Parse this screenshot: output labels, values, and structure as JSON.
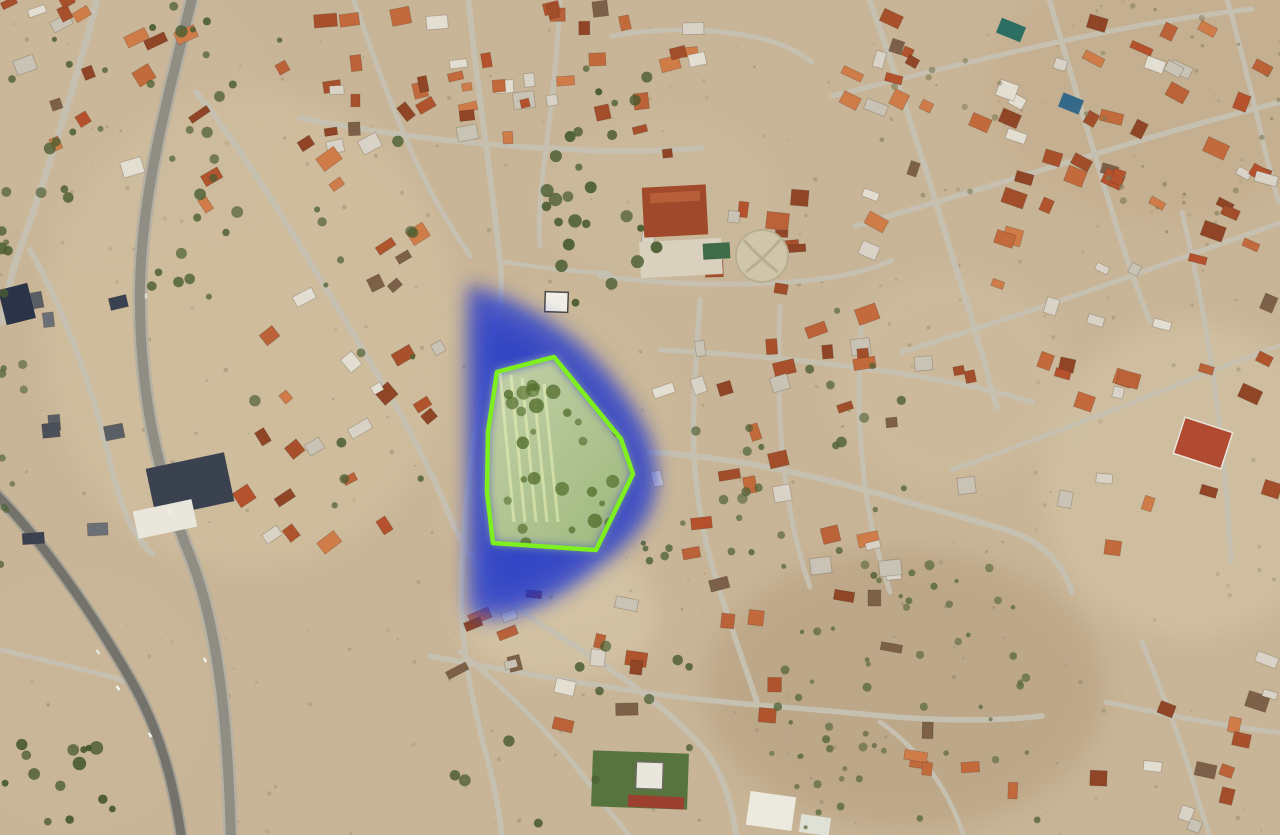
{
  "scene": {
    "width": 1280,
    "height": 835,
    "base_color": "#c8b496",
    "seed": 11
  },
  "palettes": {
    "roof": [
      "#b0542e",
      "#c26a3c",
      "#a34e2a",
      "#cf7c49",
      "#8f4526",
      "#bb6238",
      "#e3ded2",
      "#c9c3b5",
      "#7c6048",
      "#b5512c",
      "#a8502b",
      "#d8d3c6"
    ],
    "dark": [
      "#3a4150",
      "#2e3442",
      "#4a4f58",
      "#5a5f66",
      "#6b6f76"
    ],
    "road_color": "#c6c0b1",
    "building_stroke": "rgba(60,40,25,0.25)"
  },
  "fields": [
    {
      "cx": 250,
      "cy": 330,
      "rx": 210,
      "ry": 240,
      "f": "#d4c3a3",
      "o": 0.55
    },
    {
      "cx": 120,
      "cy": 120,
      "rx": 160,
      "ry": 140,
      "f": "#cdbb9d",
      "o": 0.4
    },
    {
      "cx": 560,
      "cy": 450,
      "rx": 130,
      "ry": 170,
      "f": "#cdbb9b",
      "o": 0.5
    },
    {
      "cx": 560,
      "cy": 615,
      "rx": 100,
      "ry": 65,
      "f": "#d8c9ab",
      "o": 0.6
    },
    {
      "cx": 905,
      "cy": 690,
      "rx": 200,
      "ry": 140,
      "f": "#b59e7f",
      "o": 0.55
    },
    {
      "cx": 1190,
      "cy": 480,
      "rx": 150,
      "ry": 160,
      "f": "#d6c7a9",
      "o": 0.5
    },
    {
      "cx": 1160,
      "cy": 90,
      "rx": 170,
      "ry": 130,
      "f": "#c2ab8b",
      "o": 0.5
    },
    {
      "cx": 80,
      "cy": 700,
      "rx": 130,
      "ry": 130,
      "f": "#cbb99b",
      "o": 0.5
    },
    {
      "cx": 660,
      "cy": 200,
      "rx": 120,
      "ry": 90,
      "f": "#cfbfa2",
      "o": 0.4
    },
    {
      "cx": 950,
      "cy": 380,
      "rx": 120,
      "ry": 110,
      "f": "#d2c2a4",
      "o": 0.4
    }
  ],
  "roads": [
    {
      "d": "M 98,-5 C 80,70 45,180 18,255 C 10,278 5,300 2,322",
      "w": 7
    },
    {
      "d": "M 30,250 C 60,302 92,382 112,470 C 121,506 132,536 152,553",
      "w": 6
    },
    {
      "d": "M 196,92 C 252,160 322,282 382,382 C 412,432 436,482 455,528",
      "w": 6
    },
    {
      "d": "M 455,528 C 472,566 505,600 540,624",
      "w": 5
    },
    {
      "d": "M 468,-5 C 476,80 492,180 500,262 C 506,300 490,345 480,402 C 470,462 464,520 462,566",
      "w": 6
    },
    {
      "d": "M 462,566 C 458,642 472,702 488,762 C 496,792 500,815 502,840",
      "w": 5.5
    },
    {
      "d": "M 300,118 C 392,136 472,144 542,148 C 602,152 652,152 702,148",
      "w": 5.5
    },
    {
      "d": "M 352,-5 C 372,52 396,122 426,182 C 441,212 456,236 470,256",
      "w": 5
    },
    {
      "d": "M 560,-5 C 558,50 552,100 546,150 C 541,186 538,216 540,246",
      "w": 5
    },
    {
      "d": "M 612,36 C 642,30 682,28 722,32 C 762,36 792,46 812,62",
      "w": 5
    },
    {
      "d": "M 600,276 C 660,284 732,287 802,281 C 842,277 872,270 892,260",
      "w": 5
    },
    {
      "d": "M 505,262 C 540,268 575,272 610,273",
      "w": 4.5
    },
    {
      "d": "M 648,452 C 722,456 802,472 872,492 C 932,509 982,522 1012,532 C 1042,542 1062,562 1072,592",
      "w": 6
    },
    {
      "d": "M 700,300 C 696,360 692,412 694,455 C 696,492 702,532 714,572 C 727,617 742,657 757,702",
      "w": 5.5
    },
    {
      "d": "M 780,306 C 778,360 778,412 783,457 C 787,502 796,547 810,587",
      "w": 5
    },
    {
      "d": "M 862,318 C 858,370 858,422 863,467 C 867,512 877,552 890,592",
      "w": 5
    },
    {
      "d": "M 660,350 C 742,354 832,362 922,377 C 962,384 1002,392 1032,402",
      "w": 5
    },
    {
      "d": "M 430,656 C 502,670 572,682 642,692 C 722,704 792,707 862,714 C 932,721 992,722 1042,716",
      "w": 5.5
    },
    {
      "d": "M 540,624 C 602,662 662,702 702,747 C 722,770 732,802 737,840",
      "w": 6
    },
    {
      "d": "M 460,652 C 522,702 572,757 610,812 C 620,824 627,832 632,840",
      "w": 5
    },
    {
      "d": "M 868,-5 C 892,62 917,142 942,222 C 962,287 982,352 997,407",
      "w": 6
    },
    {
      "d": "M 1048,-5 C 1066,56 1086,126 1106,192 C 1121,242 1136,287 1150,322",
      "w": 5.5
    },
    {
      "d": "M 1226,-5 C 1239,42 1253,97 1263,142 C 1269,167 1274,187 1279,202",
      "w": 5
    },
    {
      "d": "M 832,96 C 912,76 992,56 1072,39 C 1132,26 1192,16 1252,9",
      "w": 5
    },
    {
      "d": "M 855,226 C 942,201 1032,173 1122,146 C 1182,128 1237,113 1285,101",
      "w": 5.5
    },
    {
      "d": "M 902,352 C 987,326 1077,296 1167,263 C 1217,245 1257,231 1285,221",
      "w": 5
    },
    {
      "d": "M 952,470 C 1032,441 1112,411 1192,379 C 1227,365 1260,353 1285,343",
      "w": 4.5
    },
    {
      "d": "M 1182,212 C 1199,282 1211,352 1219,422 C 1225,472 1229,522 1231,562",
      "w": 5
    },
    {
      "d": "M 1142,642 C 1162,692 1182,742 1196,792 C 1203,817 1209,832 1211,840",
      "w": 5
    },
    {
      "d": "M 1106,702 C 1152,712 1202,722 1252,729 C 1264,731 1274,732 1284,733",
      "w": 5
    },
    {
      "d": "M -5,648 C 40,660 90,670 128,682",
      "w": 5
    },
    {
      "d": "M 880,722 C 920,750 950,790 965,840",
      "w": 4.5
    }
  ],
  "highways": [
    {
      "d": "M 193,-6 C 170,90 141,190 140,290 C 139,390 156,472 190,556 C 218,626 228,722 231,842",
      "wo": 15,
      "co": "#b6b0a2",
      "wi": 10,
      "ci": "#8f8d84"
    },
    {
      "d": "M -8,490 C 42,540 92,612 132,682 C 160,732 174,782 182,842",
      "wo": 13,
      "co": "#a6a295",
      "wi": 9,
      "ci": "#73736c"
    }
  ],
  "building_clusters": [
    {
      "r": [
        300,
        8,
        700,
        156
      ],
      "n": 44,
      "a": -8,
      "pal": "roof"
    },
    {
      "r": [
        850,
        4,
        1272,
        252
      ],
      "n": 56,
      "a": 22,
      "pal": "roof"
    },
    {
      "r": [
        992,
        256,
        1280,
        402
      ],
      "n": 18,
      "a": 20,
      "pal": "roof"
    },
    {
      "r": [
        655,
        302,
        982,
        602
      ],
      "n": 34,
      "a": -12,
      "pal": "roof"
    },
    {
      "r": [
        196,
        58,
        452,
        546
      ],
      "n": 36,
      "a": -33,
      "pal": "roof"
    },
    {
      "r": [
        532,
        576,
        902,
        732
      ],
      "n": 16,
      "a": 6,
      "pal": "roof"
    },
    {
      "r": [
        1148,
        656,
        1280,
        830
      ],
      "n": 12,
      "a": 14,
      "pal": "roof"
    },
    {
      "r": [
        0,
        0,
        190,
        200
      ],
      "n": 16,
      "a": -24,
      "pal": "roof"
    },
    {
      "r": [
        22,
        292,
        142,
        548
      ],
      "n": 8,
      "a": -10,
      "pal": "dark"
    },
    {
      "r": [
        620,
        196,
        806,
        298
      ],
      "n": 12,
      "a": 2,
      "pal": "roof"
    },
    {
      "r": [
        382,
        556,
        522,
        678
      ],
      "n": 8,
      "a": -20,
      "pal": "roof"
    },
    {
      "r": [
        1052,
        420,
        1280,
        562
      ],
      "n": 6,
      "a": 12,
      "pal": "roof"
    },
    {
      "r": [
        882,
        724,
        1102,
        830
      ],
      "n": 7,
      "a": 4,
      "pal": "roof"
    }
  ],
  "special_buildings": [
    {
      "x": 643,
      "y": 186,
      "w": 64,
      "h": 50,
      "rot": -3,
      "f": "#a04a2b"
    },
    {
      "x": 650,
      "y": 192,
      "w": 50,
      "h": 10,
      "rot": -3,
      "f": "#b85f3a"
    },
    {
      "x": 640,
      "y": 240,
      "w": 82,
      "h": 36,
      "rot": -3,
      "f": "#d9d1bd"
    },
    {
      "x": 703,
      "y": 243,
      "w": 27,
      "h": 16,
      "rot": -3,
      "f": "#3f6b4a"
    },
    {
      "x": 545,
      "y": 292,
      "w": 23,
      "h": 20,
      "rot": 2,
      "f": "#f1eee5",
      "s": "#4a4a46"
    },
    {
      "x": 592,
      "y": 752,
      "w": 96,
      "h": 56,
      "rot": 2,
      "f": "#57743e"
    },
    {
      "x": 636,
      "y": 762,
      "w": 27,
      "h": 27,
      "rot": 2,
      "f": "#e9e7dd",
      "s": "#6a6a60"
    },
    {
      "x": 628,
      "y": 796,
      "w": 56,
      "h": 12,
      "rot": 3,
      "f": "#9c3f2e"
    },
    {
      "x": 748,
      "y": 794,
      "w": 46,
      "h": 34,
      "rot": 8,
      "f": "#eceade"
    },
    {
      "x": 800,
      "y": 816,
      "w": 30,
      "h": 18,
      "rot": 8,
      "f": "#dfe0d6"
    },
    {
      "x": 1178,
      "y": 424,
      "w": 50,
      "h": 38,
      "rot": 18,
      "f": "#b04a30",
      "s": "#e8e4da"
    },
    {
      "x": 998,
      "y": 22,
      "w": 26,
      "h": 16,
      "rot": 22,
      "f": "#2e6e62"
    },
    {
      "x": 1060,
      "y": 96,
      "w": 22,
      "h": 15,
      "rot": 22,
      "f": "#35698a"
    },
    {
      "x": 2,
      "y": 286,
      "w": 30,
      "h": 36,
      "rot": -14,
      "f": "#2b3348"
    },
    {
      "x": 150,
      "y": 460,
      "w": 80,
      "h": 50,
      "rot": -12,
      "f": "#3a4250"
    },
    {
      "x": 135,
      "y": 505,
      "w": 60,
      "h": 28,
      "rot": -12,
      "f": "#e9e6dc"
    }
  ],
  "park": {
    "cx": 762,
    "cy": 256,
    "r": 26,
    "f": "#cfc5a9",
    "path_color": "#b9ae92"
  },
  "tree_clusters": [
    {
      "r": [
        150,
        0,
        215,
        300
      ],
      "n": 18,
      "rad": [
        3,
        6.5
      ],
      "c": "#4c5e31",
      "o": 0.85
    },
    {
      "r": [
        0,
        120,
        70,
        320
      ],
      "n": 10,
      "rad": [
        3,
        6
      ],
      "c": "#4c5e31",
      "o": 0.8
    },
    {
      "r": [
        0,
        330,
        25,
        570
      ],
      "n": 9,
      "rad": [
        2.5,
        5
      ],
      "c": "#51633a",
      "o": 0.75
    },
    {
      "r": [
        540,
        150,
        660,
        305
      ],
      "n": 18,
      "rad": [
        3.5,
        7
      ],
      "c": "#465a2d",
      "o": 0.85
    },
    {
      "r": [
        770,
        556,
        1045,
        830
      ],
      "n": 56,
      "rad": [
        2,
        4.5
      ],
      "c": "#5d6b3f",
      "o": 0.8
    },
    {
      "r": [
        0,
        735,
        115,
        832
      ],
      "n": 14,
      "rad": [
        3,
        7
      ],
      "c": "#3f5329",
      "o": 0.85
    },
    {
      "r": [
        640,
        415,
        770,
        565
      ],
      "n": 12,
      "rad": [
        2.5,
        5.5
      ],
      "c": "#51643a",
      "o": 0.8
    },
    {
      "r": [
        250,
        140,
        430,
        520
      ],
      "n": 14,
      "rad": [
        2.5,
        6
      ],
      "c": "#4e6034",
      "o": 0.8
    },
    {
      "r": [
        660,
        306,
        950,
        592
      ],
      "n": 20,
      "rad": [
        2.5,
        5.5
      ],
      "c": "#4e6034",
      "o": 0.75
    },
    {
      "r": [
        0,
        15,
        290,
        245
      ],
      "n": 14,
      "rad": [
        2.5,
        6
      ],
      "c": "#485a2e",
      "o": 0.8
    },
    {
      "r": [
        430,
        640,
        710,
        830
      ],
      "n": 12,
      "rad": [
        3,
        6
      ],
      "c": "#4a5c30",
      "o": 0.8
    },
    {
      "r": [
        1080,
        0,
        1280,
        235
      ],
      "n": 26,
      "rad": [
        1.5,
        3.5
      ],
      "c": "#7b7852",
      "o": 0.55
    },
    {
      "r": [
        560,
        60,
        650,
        170
      ],
      "n": 8,
      "rad": [
        3,
        6
      ],
      "c": "#465a2d",
      "o": 0.85
    },
    {
      "r": [
        840,
        60,
        1000,
        200
      ],
      "n": 10,
      "rad": [
        2,
        4
      ],
      "c": "#6e7046",
      "o": 0.5
    }
  ],
  "scrub": {
    "n": 300,
    "rad": [
      0.8,
      2.4
    ],
    "cols": [
      "#8f7f62",
      "#6e6f4c",
      "#a5916f"
    ],
    "o": 0.3
  },
  "vehicles": [
    {
      "x": 118,
      "y": 688,
      "r": 52,
      "c": "#f5f5f0"
    },
    {
      "x": 98,
      "y": 652,
      "r": 52,
      "c": "#e8e8e0"
    },
    {
      "x": 150,
      "y": 735,
      "r": 55,
      "c": "#f2f2ec"
    },
    {
      "x": 170,
      "y": 512,
      "r": 78,
      "c": "#eeeee8"
    },
    {
      "x": 146,
      "y": 296,
      "r": 88,
      "c": "#dddbd2"
    },
    {
      "x": 205,
      "y": 660,
      "r": 60,
      "c": "#f0efe8"
    }
  ],
  "annotation": {
    "blob_outer": "M 468,285 C 500,292 540,312 575,340 C 602,362 628,395 646,430 C 658,455 662,486 650,512 C 636,540 610,558 588,575 C 562,596 532,610 505,617 C 492,620 478,618 468,614 Z",
    "blob_inner": "M 480,310 C 515,322 550,345 580,375 C 605,400 625,430 635,460 C 640,488 630,512 612,532 C 592,554 568,572 542,588 C 518,600 496,605 482,600 Z",
    "blob_color": "#2039d2",
    "blob_inner_color": "#1830c6",
    "blob_opacity": 0.72,
    "blob_inner_opacity": 0.5,
    "polygon_points": "554,357 497,372 488,432 487,492 493,543 596,550 633,474 621,439",
    "stroke": "#7df01e",
    "stroke_width": 4.5,
    "fill_top": "#e9f4a2",
    "fill_bottom": "#b7d36a",
    "fill_opacity": 0.8,
    "interior_trees": {
      "r": [
        500,
        385,
        625,
        545
      ],
      "n": 30,
      "rad": [
        3,
        7.5
      ],
      "c": "#55702f",
      "o": 0.75
    },
    "striations": {
      "n": 5,
      "x0": 500,
      "y0": 372,
      "dx": 11,
      "len": 150,
      "c": "#f0f7bb",
      "o": 0.5,
      "w": 3
    }
  }
}
